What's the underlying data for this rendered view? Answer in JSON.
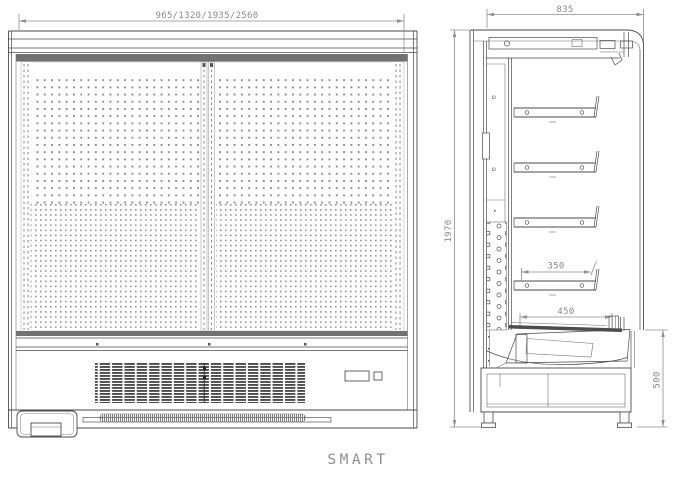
{
  "drawing": {
    "product_name": "SMART",
    "type_label": "refrigerated multideck display case technical drawing",
    "views": {
      "front": {
        "label": "front-view",
        "dimensions": {
          "width_options": "965/1320/1935/2560"
        }
      },
      "side": {
        "label": "side-view",
        "dimensions": {
          "depth": "835",
          "height": "1970",
          "shelf_depth": "350",
          "deck_depth": "450",
          "base_height": "500"
        }
      }
    },
    "colors": {
      "background": "#ffffff",
      "line": "#4a4a4a",
      "dim_line": "#8f8f8f",
      "text": "#8a8a8a",
      "dark_band": "#717171",
      "perforation_dot": "#8d8d8d",
      "grille_slat": "#4d4d4d"
    }
  }
}
